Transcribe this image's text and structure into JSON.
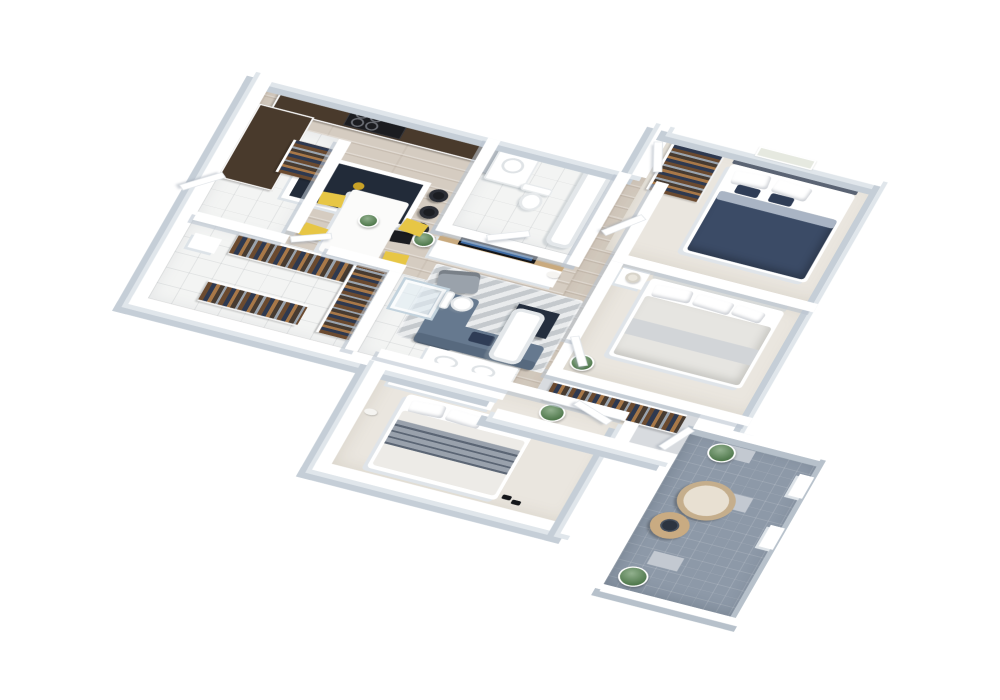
{
  "scene": {
    "type": "3d-floor-plan",
    "view": "isometric",
    "background": "#ffffff",
    "description": "Isometric 3D rendering of an apartment floor plan with open kitchen, dining area, living area, three bedrooms, two bathrooms, walk-in closet, hallway closet and a tiled balcony"
  },
  "palette": {
    "wall_top": "#ffffff",
    "wall_face": "#c5ced7",
    "floor_wood": "#d5ccc1",
    "floor_carpet": "#eae6df",
    "floor_tile": "#f3f4f3",
    "floor_corridor": "#d8dbdf",
    "floor_balcony": "#8d99a8",
    "balcony_accent": "#c3c9d1",
    "counter_top": "#493a2c",
    "island_top": "#222b39",
    "stove": "#1b1c20",
    "appliance": "#b7bdc4",
    "dining_table": "#fbfbfa",
    "chair_yellow": "#e7c645",
    "rug": "#d3d7da",
    "sofa": "#66798f",
    "sofa_back": "#57697e",
    "coffee_table": "#242e3e",
    "armchair": "#9aa2ab",
    "bed1_duvet": "#3b4b66",
    "bed1_fold": "#a9b4c4",
    "headboard_dark": "#5a6373",
    "pillow_navy": "#2f3d56",
    "bed2_duvet": "#e6e5e1",
    "bed2_throw": "#d2d5d8",
    "headboard_light": "#d8dad9",
    "bed3_sheet": "#edebe7",
    "bed3_blanket": "#99a1ac",
    "dresser_wood": "#c9aa7e",
    "tv_black": "#14161a",
    "tv_screen": "#3e6ba3",
    "plant": "#4f8049",
    "gold_decor": "#c9a227",
    "lamp": "#eae6dd",
    "cat": "#f5f4f1",
    "wicker": "#c5ae8c",
    "wicker_cushion": "#e8e0d2",
    "table_wood": "#c9ab82",
    "tray_dark": "#2c3440"
  },
  "rooms": [
    {
      "id": "kitchen",
      "label": "Kitchen",
      "floor": "wood",
      "furniture": [
        "l-shaped counter with dark countertop",
        "stove",
        "refrigerator",
        "navy kitchen island",
        "3 bar stools",
        "2 black chairs"
      ]
    },
    {
      "id": "dining-area",
      "label": "Dining Area",
      "floor": "wood",
      "furniture": [
        "white dining table",
        "4 yellow chairs",
        "plant centerpiece"
      ]
    },
    {
      "id": "central-bathroom",
      "label": "Bathroom",
      "floor": "tile",
      "furniture": [
        "vanity with sink",
        "toilet",
        "bathtub"
      ]
    },
    {
      "id": "living-area",
      "label": "Living Area",
      "floor": "wood",
      "furniture": [
        "tv console",
        "tv",
        "white cat",
        "patterned rug",
        "blue sofa with chaise",
        "navy cube coffee table",
        "gray armchair",
        "potted plant"
      ]
    },
    {
      "id": "bedroom-1",
      "label": "Bedroom 1",
      "floor": "carpet",
      "furniture": [
        "double bed with navy duvet",
        "wall art",
        "open closet with clothes"
      ]
    },
    {
      "id": "bedroom-2",
      "label": "Bedroom 2",
      "floor": "carpet",
      "furniture": [
        "double bed with light bedding",
        "nightstand",
        "table lamp",
        "potted plant"
      ]
    },
    {
      "id": "bedroom-3",
      "label": "Bedroom 3",
      "floor": "carpet",
      "furniture": [
        "double bed with striped blanket",
        "dresser with tv",
        "white cat",
        "slippers"
      ]
    },
    {
      "id": "walk-in-closet",
      "label": "Walk-in Closet",
      "floor": "tile",
      "furniture": [
        "l-shaped clothes racks",
        "bench"
      ]
    },
    {
      "id": "second-bathroom",
      "label": "Bathroom 2",
      "floor": "tile",
      "furniture": [
        "glass shower",
        "toilet",
        "double sink counter",
        "bathtub"
      ]
    },
    {
      "id": "hallway-closet",
      "label": "Hallway Closet",
      "floor": "corridor",
      "furniture": [
        "clothes rack",
        "potted plant"
      ]
    },
    {
      "id": "entry",
      "label": "Entry",
      "floor": "tile",
      "furniture": [
        "wardrobe with clothes",
        "doors"
      ]
    },
    {
      "id": "balcony",
      "label": "Balcony",
      "floor": "balcony-tile",
      "furniture": [
        "round wicker chair",
        "round wooden table with tray",
        "2 potted plants",
        "white planters"
      ]
    }
  ]
}
